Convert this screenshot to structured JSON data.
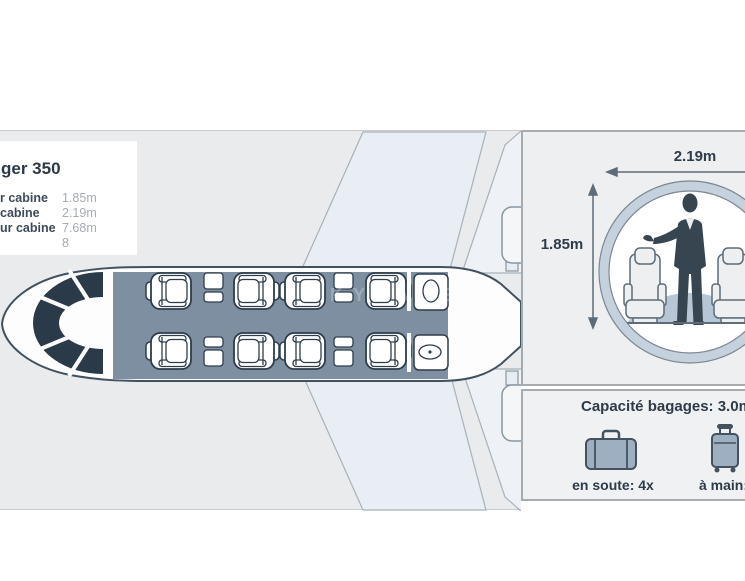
{
  "spec_panel": {
    "title": "ger 350",
    "rows": [
      {
        "label": "r cabine",
        "value": "1.85m"
      },
      {
        "label": "cabine",
        "value": "2.19m"
      },
      {
        "label": "ur cabine",
        "value": "7.68m"
      },
      {
        "label": "",
        "value": "8"
      }
    ]
  },
  "cross_section": {
    "width_label": "2.19m",
    "height_label": "1.85m"
  },
  "baggage": {
    "title": "Capacité bagages: 3.0m³",
    "hold_label": "en soute: 4x",
    "carry_on_label": "à main: 4x"
  },
  "watermark": "SKYVALET",
  "cabin_layout": {
    "passenger_seats": 8,
    "tables": 4,
    "lavatory": "aft",
    "cockpit": "forward"
  },
  "colors": {
    "accent_text": "#2e3b49",
    "value_text": "#a6abb1",
    "panel_bg": "#e9ebec",
    "panel_border": "#a6abb0",
    "cabin_fill": "#7d8fa0",
    "cockpit_fill": "#2b3a49",
    "ring_fill": "#c5d1dd",
    "floor_fill": "#b7c6d4",
    "silhouette": "#36454f",
    "luggage_fill": "#9dafc0",
    "luggage_stroke": "#43525e"
  }
}
